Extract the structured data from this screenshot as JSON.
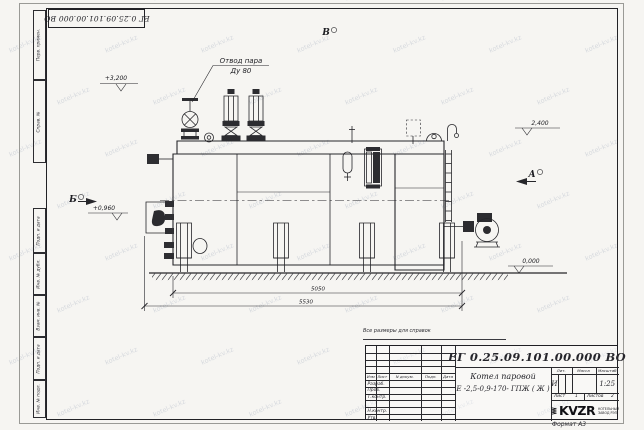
{
  "watermark": {
    "text": "kotel-kv.kz"
  },
  "top_stamp": {
    "doc_number": "ЕГ 0.25.09.101.00.000  ВО"
  },
  "margin_fields": {
    "items": [
      "Перв. примен.",
      "Справ. №",
      "Подп. и дата",
      "Инв. № дубл.",
      "Взам. инв. №",
      "Подп. и дата",
      "Инв. № подл."
    ]
  },
  "drawing": {
    "callout_line1": "Отвод пара",
    "callout_line2": "Ду 80",
    "elev_3200": "+3,200",
    "elev_2400": "2,400",
    "elev_0960": "+0,960",
    "elev_0000": "0,000",
    "dim_5050": "5050",
    "dim_5530": "5530",
    "sec_b": "Б",
    "sec_v": "В",
    "sec_a": "А"
  },
  "note": "Все размеры для справок",
  "title_block": {
    "doc_number": "ЕГ 0.25.09.101.00.000  ВО",
    "product_name_line1": "Котел паровой",
    "product_name_line2": "Е -2,5-0,9-170- ГПЖ ( Ж )",
    "header_cols": [
      "Изм",
      "Лист",
      "N докум.",
      "Подп.",
      "Дата"
    ],
    "sign_rows": [
      "Разраб.",
      "Пров.",
      "Т.контр.",
      "Н.контр.",
      "Утв."
    ],
    "lit_header": [
      "Лит.",
      "Масса",
      "Масштаб"
    ],
    "lit_value": "И",
    "scale": "1:25",
    "sheet_label": "Лист",
    "sheet_value": "1",
    "sheets_label": "Листов",
    "sheets_value": "2",
    "logo_text": "KVZR",
    "logo_sub1": "КОТЕЛЬНЫЙ",
    "logo_sub2": "ЗАВОД РЭП",
    "format_label": "Формат  А3"
  }
}
